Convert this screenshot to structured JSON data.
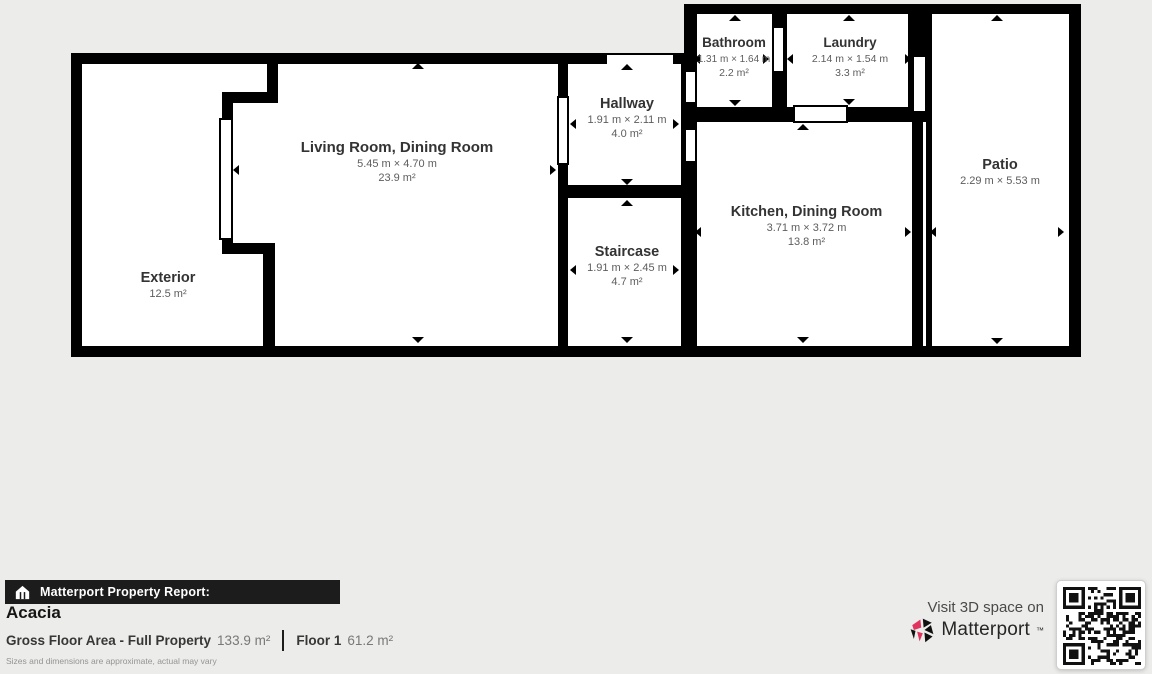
{
  "plan": {
    "rooms": {
      "living": {
        "title": "Living Room, Dining Room",
        "dims": "5.45 m × 4.70 m",
        "area": "23.9 m²"
      },
      "exterior": {
        "title": "Exterior",
        "area": "12.5 m²"
      },
      "hallway": {
        "title": "Hallway",
        "dims": "1.91 m × 2.11 m",
        "area": "4.0 m²"
      },
      "staircase": {
        "title": "Staircase",
        "dims": "1.91 m × 2.45 m",
        "area": "4.7 m²"
      },
      "bathroom": {
        "title": "Bathroom",
        "dims": "1.31 m × 1.64 m",
        "area": "2.2 m²"
      },
      "laundry": {
        "title": "Laundry",
        "dims": "2.14 m × 1.54 m",
        "area": "3.3 m²"
      },
      "kitchen": {
        "title": "Kitchen, Dining Room",
        "dims": "3.71 m × 3.72 m",
        "area": "13.8 m²"
      },
      "patio": {
        "title": "Patio",
        "dims": "2.29 m × 5.53 m"
      }
    }
  },
  "footer": {
    "report_label": "Matterport Property Report:",
    "property_name": "Acacia",
    "gfa_label": "Gross Floor Area - Full Property",
    "gfa_value": "133.9 m²",
    "floor_label": "Floor 1",
    "floor_value": "61.2 m²",
    "disclaimer": "Sizes and dimensions are approximate, actual may vary",
    "visit_text": "Visit 3D space on",
    "brand": "Matterport",
    "brand_tm": "™"
  },
  "colors": {
    "background": "#ececea",
    "wall": "#000000",
    "room_fill": "#ffffff",
    "report_bar": "#1c1c1c",
    "brand_red": "#e0335e",
    "title_text": "#333333",
    "dim_text": "#5d5d5d"
  }
}
